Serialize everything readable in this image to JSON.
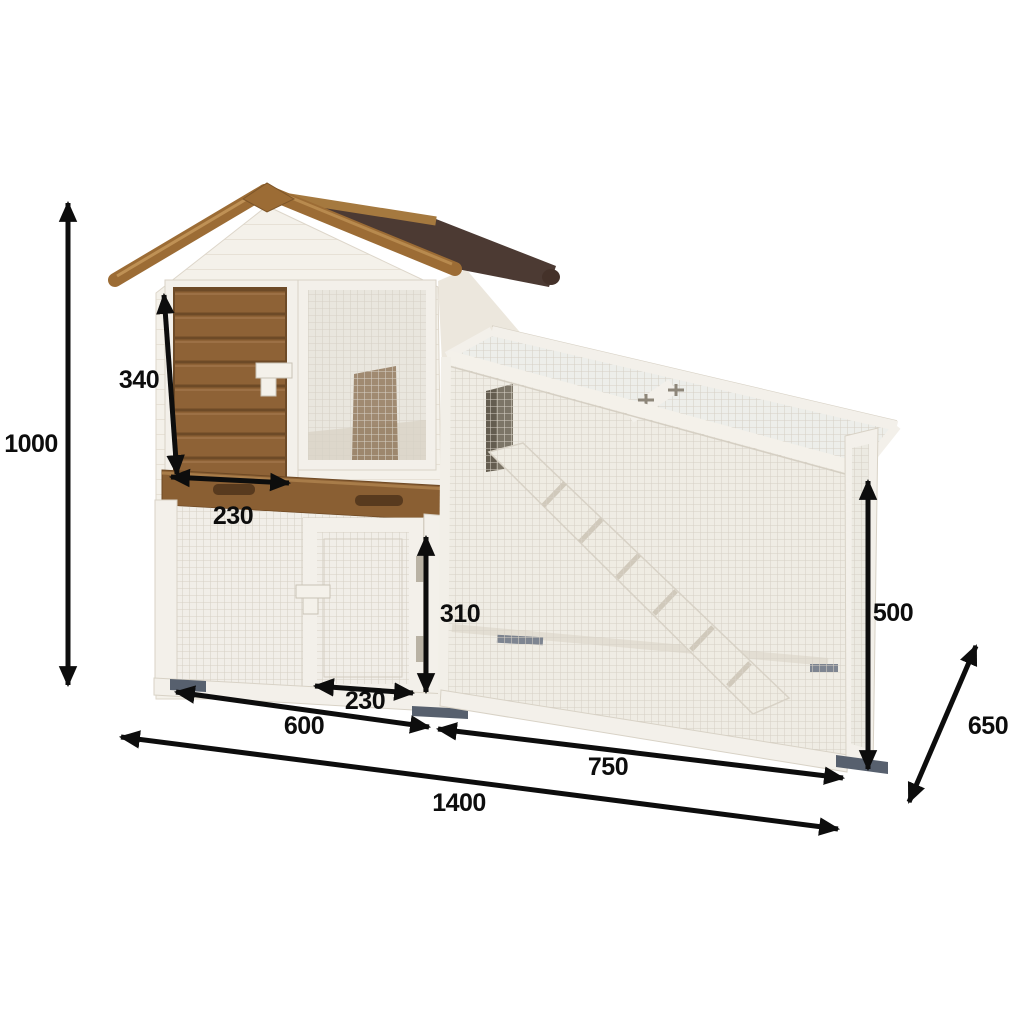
{
  "figure": {
    "type": "product-dimension-diagram",
    "subject": "Two-storey wooden rabbit hutch with gable roof and attached mesh run",
    "background": "#ffffff"
  },
  "dimensions": {
    "overall_height": "1000",
    "hutch_door_height": "340",
    "hutch_door_width": "230",
    "run_door_height": "310",
    "run_door_width": "230",
    "left_section_width": "600",
    "run_section_width": "750",
    "overall_length": "1400",
    "run_height": "500",
    "depth": "650"
  },
  "colors": {
    "annotation": "#0d0d0d",
    "roof_shingle": "#4c3a33",
    "wood_trim": "#9c6c35",
    "wood_door": "#8e6236",
    "painted_wood": "#f3f0ea",
    "mesh_line": "#d6d0c5",
    "feet": "#57606e"
  }
}
